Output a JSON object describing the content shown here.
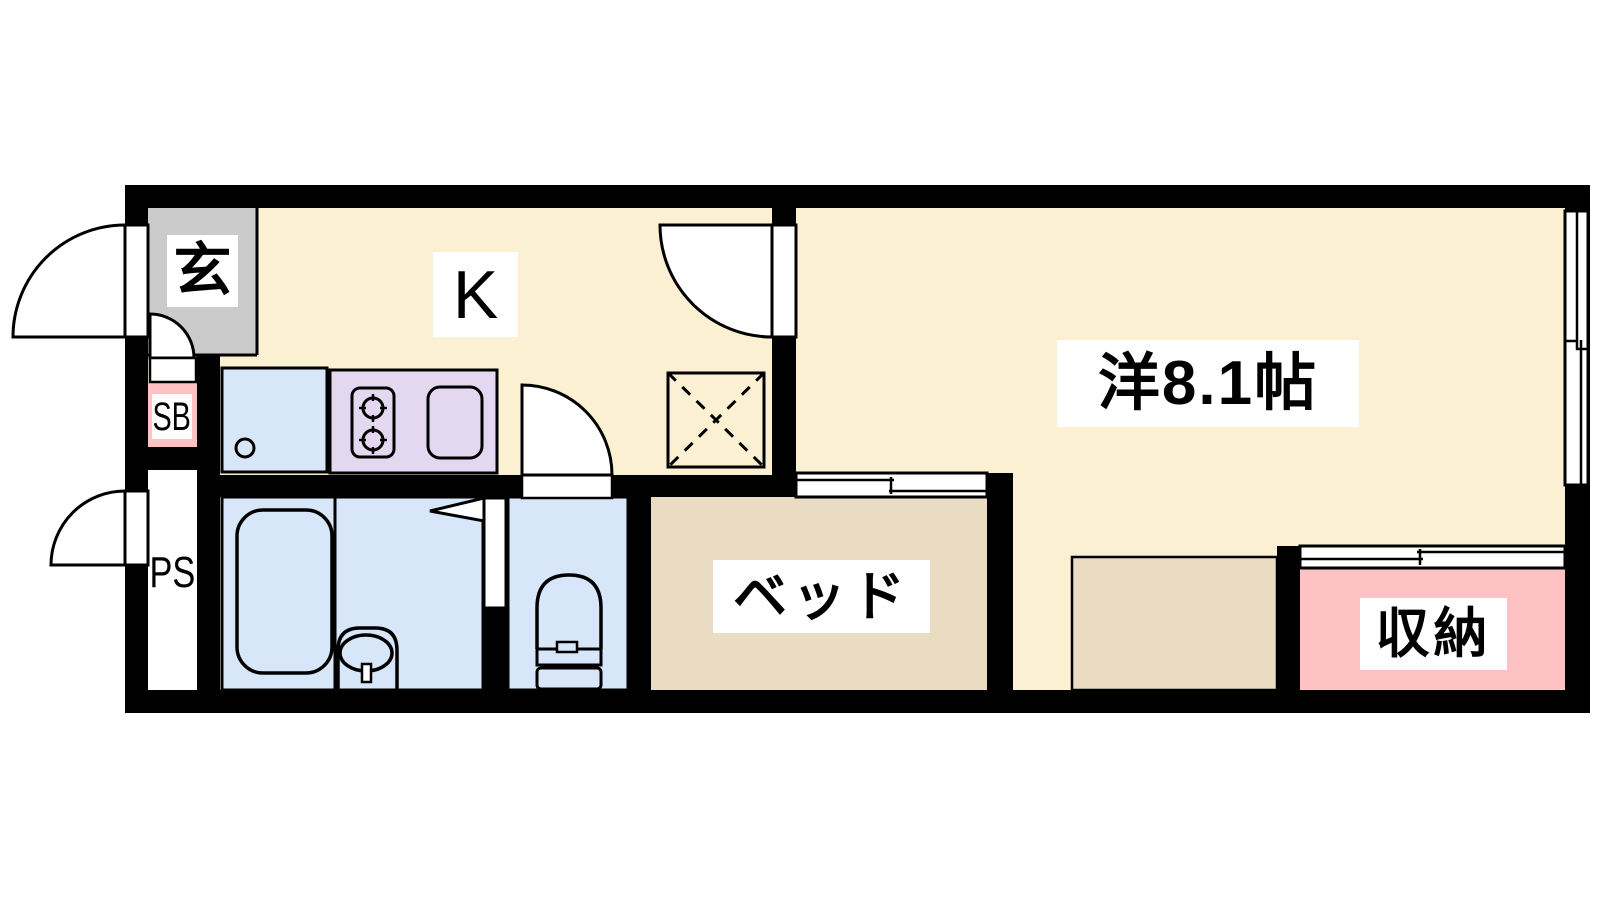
{
  "floorplan": {
    "type": "apartment-room-layout",
    "rooms": {
      "entrance": {
        "label": "玄"
      },
      "kitchen": {
        "label": "K"
      },
      "western_room": {
        "label": "洋8.1帖",
        "size_tatami": 8.1
      },
      "bed": {
        "label": "ベッド"
      },
      "storage": {
        "label": "収納"
      },
      "shoe_box": {
        "label": "SB"
      },
      "pipe_space": {
        "label": "PS"
      }
    },
    "fixtures": [
      "bathtub",
      "washbasin",
      "toilet",
      "kitchen-sink",
      "gas-stove",
      "refrigerator-space"
    ],
    "colors": {
      "wall": "#000000",
      "floor": "#FCF0D2",
      "entrance_floor": "#CBCBCB",
      "wet_area": "#D7E6F8",
      "stove": "#E4D7F0",
      "accent_pink": "#FFC2C4",
      "bed_tan": "#E9DCC2",
      "line": "#000000",
      "paper": "#FFFFFF"
    }
  }
}
